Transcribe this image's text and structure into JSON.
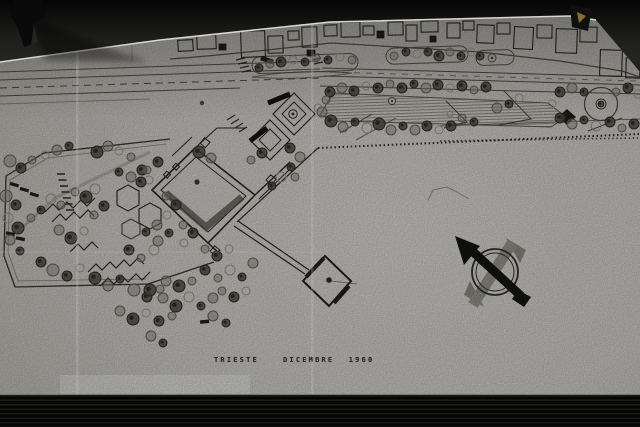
{
  "photo": {
    "description": "black and white photograph of an architectural waterfront site plan drawing pinned on a dark board",
    "caption": {
      "city": "TRIESTE",
      "date": "DICEMBRE 1960"
    },
    "colors": {
      "photo_background": "#0b0b0a",
      "paper": "#c6c5c0",
      "paper_highlight": "#d3d2cd",
      "ink": "#2b2a25",
      "tree_dark": "#46453f",
      "tree_mid": "#7f7e76",
      "tree_light": "#908f86",
      "compass_black": "#141411",
      "compass_gray": "#8d8c85",
      "clip_gold": "#8a6d2f"
    },
    "icons": {
      "north_arrow": "north-arrow-compass-icon",
      "clip_top_left": "binder-clip-icon",
      "clip_top_right": "paper-clamp-icon"
    }
  },
  "map": {
    "trees": [
      [
        10,
        161,
        6,
        1
      ],
      [
        21,
        168,
        5,
        2
      ],
      [
        32,
        160,
        4,
        1
      ],
      [
        45,
        155,
        4,
        0
      ],
      [
        57,
        150,
        5,
        1
      ],
      [
        69,
        146,
        4,
        2
      ],
      [
        97,
        152,
        6,
        2
      ],
      [
        108,
        146,
        5,
        1
      ],
      [
        119,
        151,
        4,
        0
      ],
      [
        131,
        157,
        4,
        1
      ],
      [
        142,
        170,
        5,
        2
      ],
      [
        131,
        177,
        5,
        1
      ],
      [
        119,
        172,
        4,
        2
      ],
      [
        149,
        180,
        4,
        0
      ],
      [
        6,
        196,
        6,
        1
      ],
      [
        16,
        205,
        5,
        2
      ],
      [
        8,
        218,
        5,
        0
      ],
      [
        18,
        228,
        6,
        2
      ],
      [
        10,
        240,
        5,
        1
      ],
      [
        20,
        251,
        4,
        2
      ],
      [
        31,
        218,
        4,
        1
      ],
      [
        41,
        210,
        4,
        2
      ],
      [
        51,
        199,
        5,
        0
      ],
      [
        61,
        205,
        4,
        1
      ],
      [
        86,
        197,
        6,
        2
      ],
      [
        75,
        192,
        4,
        1
      ],
      [
        95,
        189,
        5,
        0
      ],
      [
        104,
        206,
        5,
        2
      ],
      [
        94,
        215,
        4,
        1
      ],
      [
        59,
        230,
        5,
        1
      ],
      [
        71,
        238,
        6,
        2
      ],
      [
        84,
        231,
        4,
        0
      ],
      [
        41,
        262,
        5,
        2
      ],
      [
        53,
        270,
        6,
        1
      ],
      [
        67,
        276,
        5,
        2
      ],
      [
        80,
        268,
        4,
        0
      ],
      [
        95,
        278,
        6,
        2
      ],
      [
        108,
        286,
        5,
        1
      ],
      [
        120,
        279,
        4,
        2
      ],
      [
        134,
        290,
        6,
        1
      ],
      [
        147,
        297,
        5,
        2
      ],
      [
        160,
        289,
        4,
        1
      ],
      [
        129,
        250,
        5,
        2
      ],
      [
        141,
        258,
        4,
        1
      ],
      [
        154,
        250,
        5,
        0
      ],
      [
        146,
        232,
        4,
        2
      ],
      [
        158,
        241,
        5,
        1
      ],
      [
        166,
        196,
        4,
        1
      ],
      [
        176,
        205,
        5,
        2
      ],
      [
        167,
        215,
        4,
        0
      ],
      [
        157,
        225,
        5,
        1
      ],
      [
        169,
        233,
        4,
        2
      ],
      [
        183,
        225,
        4,
        1
      ],
      [
        193,
        233,
        5,
        2
      ],
      [
        184,
        243,
        4,
        0
      ],
      [
        150,
        290,
        6,
        2
      ],
      [
        163,
        298,
        5,
        1
      ],
      [
        176,
        306,
        6,
        2
      ],
      [
        189,
        297,
        5,
        0
      ],
      [
        201,
        306,
        4,
        2
      ],
      [
        213,
        298,
        5,
        1
      ],
      [
        166,
        281,
        5,
        1
      ],
      [
        179,
        286,
        6,
        2
      ],
      [
        192,
        281,
        4,
        1
      ],
      [
        205,
        270,
        5,
        2
      ],
      [
        218,
        278,
        4,
        1
      ],
      [
        230,
        270,
        5,
        0
      ],
      [
        242,
        277,
        4,
        2
      ],
      [
        253,
        263,
        5,
        1
      ],
      [
        120,
        311,
        5,
        1
      ],
      [
        133,
        319,
        6,
        2
      ],
      [
        146,
        313,
        4,
        0
      ],
      [
        159,
        321,
        5,
        2
      ],
      [
        172,
        316,
        4,
        1
      ],
      [
        151,
        336,
        5,
        1
      ],
      [
        163,
        343,
        4,
        2
      ],
      [
        205,
        249,
        4,
        1
      ],
      [
        217,
        256,
        5,
        2
      ],
      [
        229,
        249,
        4,
        0
      ],
      [
        222,
        291,
        4,
        1
      ],
      [
        234,
        297,
        5,
        2
      ],
      [
        246,
        291,
        4,
        0
      ],
      [
        213,
        316,
        5,
        1
      ],
      [
        226,
        323,
        4,
        2
      ],
      [
        199,
        152,
        6,
        2
      ],
      [
        211,
        158,
        5,
        1
      ],
      [
        158,
        162,
        5,
        2
      ],
      [
        147,
        170,
        4,
        1
      ],
      [
        141,
        182,
        5,
        2
      ],
      [
        290,
        148,
        5,
        2
      ],
      [
        300,
        157,
        5,
        1
      ],
      [
        291,
        167,
        4,
        2
      ],
      [
        281,
        177,
        5,
        0
      ],
      [
        272,
        186,
        4,
        2
      ],
      [
        295,
        177,
        4,
        1
      ],
      [
        251,
        160,
        4,
        1
      ],
      [
        262,
        153,
        5,
        2
      ],
      [
        259,
        68,
        4,
        2
      ],
      [
        270,
        64,
        4,
        1
      ],
      [
        281,
        62,
        5,
        2
      ],
      [
        293,
        60,
        4,
        0
      ],
      [
        305,
        62,
        4,
        2
      ],
      [
        316,
        58,
        4,
        1
      ],
      [
        328,
        60,
        4,
        2
      ],
      [
        340,
        57,
        4,
        0
      ],
      [
        352,
        60,
        4,
        1
      ],
      [
        394,
        56,
        4,
        1
      ],
      [
        406,
        52,
        4,
        2
      ],
      [
        417,
        54,
        4,
        0
      ],
      [
        428,
        52,
        4,
        2
      ],
      [
        439,
        56,
        5,
        2
      ],
      [
        450,
        52,
        4,
        1
      ],
      [
        461,
        56,
        4,
        2
      ],
      [
        471,
        52,
        4,
        0
      ],
      [
        480,
        56,
        4,
        2
      ],
      [
        330,
        92,
        5,
        2
      ],
      [
        342,
        88,
        5,
        1
      ],
      [
        354,
        91,
        5,
        2
      ],
      [
        366,
        86,
        4,
        0
      ],
      [
        378,
        88,
        5,
        2
      ],
      [
        390,
        84,
        4,
        1
      ],
      [
        402,
        88,
        5,
        2
      ],
      [
        414,
        84,
        4,
        2
      ],
      [
        426,
        88,
        5,
        1
      ],
      [
        438,
        85,
        5,
        2
      ],
      [
        450,
        88,
        4,
        0
      ],
      [
        462,
        86,
        5,
        2
      ],
      [
        474,
        90,
        4,
        1
      ],
      [
        486,
        87,
        5,
        2
      ],
      [
        322,
        112,
        5,
        1
      ],
      [
        331,
        121,
        6,
        2
      ],
      [
        343,
        127,
        5,
        1
      ],
      [
        355,
        122,
        4,
        2
      ],
      [
        367,
        128,
        5,
        0
      ],
      [
        379,
        124,
        6,
        2
      ],
      [
        391,
        130,
        5,
        1
      ],
      [
        403,
        126,
        4,
        2
      ],
      [
        415,
        130,
        5,
        1
      ],
      [
        427,
        126,
        5,
        2
      ],
      [
        439,
        130,
        4,
        0
      ],
      [
        451,
        126,
        5,
        2
      ],
      [
        497,
        108,
        5,
        1
      ],
      [
        509,
        104,
        4,
        2
      ],
      [
        519,
        98,
        4,
        0
      ],
      [
        560,
        92,
        5,
        2
      ],
      [
        572,
        88,
        5,
        1
      ],
      [
        584,
        92,
        4,
        2
      ],
      [
        552,
        104,
        4,
        0
      ],
      [
        560,
        118,
        5,
        2
      ],
      [
        572,
        124,
        5,
        1
      ],
      [
        584,
        120,
        4,
        2
      ],
      [
        596,
        126,
        5,
        0
      ],
      [
        610,
        122,
        5,
        2
      ],
      [
        622,
        128,
        4,
        1
      ],
      [
        634,
        124,
        5,
        2
      ],
      [
        616,
        92,
        4,
        1
      ],
      [
        628,
        88,
        5,
        2
      ],
      [
        638,
        94,
        4,
        0
      ],
      [
        326,
        100,
        4,
        1
      ],
      [
        318,
        108,
        4,
        0
      ],
      [
        462,
        118,
        4,
        1
      ],
      [
        474,
        122,
        4,
        2
      ],
      [
        450,
        114,
        3,
        0
      ],
      [
        601,
        104,
        3,
        2
      ]
    ],
    "buildings": [
      [
        178,
        40,
        15,
        11,
        -3,
        0
      ],
      [
        197,
        35,
        19,
        14,
        -2,
        0
      ],
      [
        219,
        44,
        7,
        6,
        0,
        1
      ],
      [
        241,
        31,
        24,
        26,
        -2,
        0
      ],
      [
        268,
        36,
        15,
        17,
        -1,
        0
      ],
      [
        261,
        58,
        12,
        4,
        18,
        1
      ],
      [
        288,
        31,
        11,
        9,
        -2,
        0
      ],
      [
        302,
        27,
        15,
        20,
        -1,
        0
      ],
      [
        307,
        50,
        8,
        6,
        0,
        1
      ],
      [
        324,
        25,
        13,
        11,
        -2,
        0
      ],
      [
        341,
        22,
        19,
        15,
        -1,
        0
      ],
      [
        363,
        26,
        11,
        9,
        0,
        0
      ],
      [
        377,
        31,
        7,
        7,
        0,
        1
      ],
      [
        388,
        22,
        15,
        13,
        -1,
        0
      ],
      [
        406,
        25,
        11,
        16,
        0,
        0
      ],
      [
        421,
        21,
        17,
        11,
        -1,
        0
      ],
      [
        430,
        36,
        6,
        6,
        0,
        1
      ],
      [
        447,
        23,
        13,
        15,
        0,
        0
      ],
      [
        463,
        21,
        11,
        9,
        -1,
        0
      ],
      [
        477,
        25,
        17,
        18,
        2,
        0
      ],
      [
        497,
        23,
        13,
        11,
        0,
        0
      ],
      [
        514,
        27,
        19,
        22,
        3,
        0
      ],
      [
        537,
        25,
        15,
        13,
        1,
        0
      ],
      [
        556,
        29,
        21,
        24,
        2,
        0
      ],
      [
        580,
        27,
        17,
        15,
        1,
        0
      ],
      [
        600,
        50,
        22,
        26,
        2,
        0
      ],
      [
        626,
        58,
        14,
        20,
        2,
        0
      ]
    ]
  }
}
